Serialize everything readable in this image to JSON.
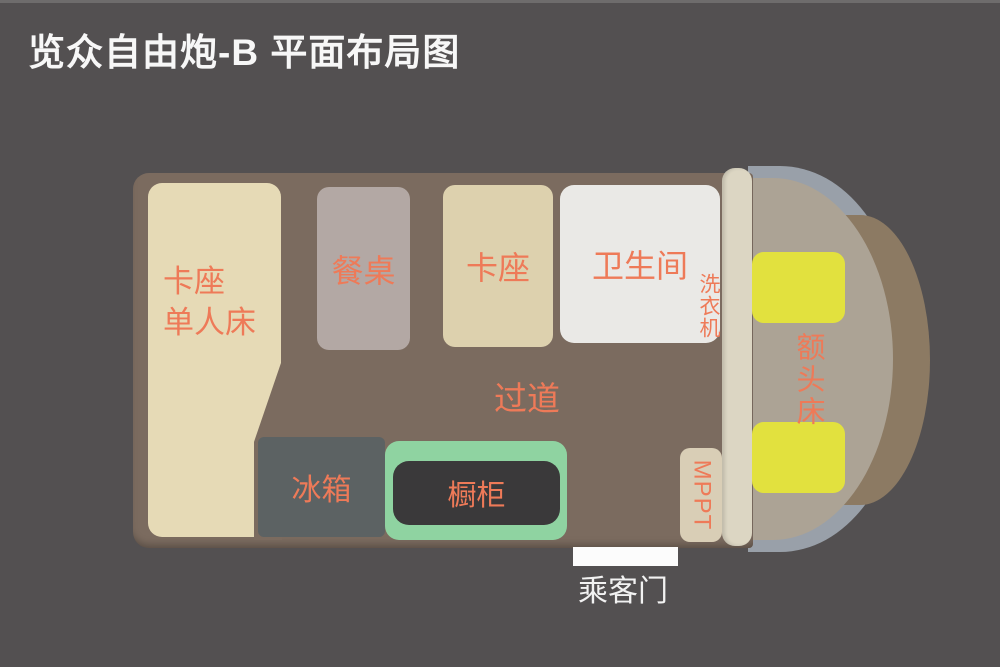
{
  "title": "览众自由炮-B 平面布局图",
  "colors": {
    "background": "#535051",
    "floor": "#7b6b5f",
    "bed": "#e6dab6",
    "dining_table": "#b3a8a4",
    "booth": "#ddd1ae",
    "bathroom": "#eae9e6",
    "fridge": "#5c6263",
    "cabinet_frame": "#8fd3a1",
    "cabinet_inner": "#3a393a",
    "seat": "#e2e13e",
    "partition": "#dcd6c3",
    "cab_floor": "#aca395",
    "windshield_band": "#99a0a9",
    "hood": "#8c7a63",
    "label_orange": "#ee7a58",
    "door_white": "#fcfcfc",
    "title_white": "#f7f7f7"
  },
  "floorplan": {
    "bed": {
      "line1": "卡座",
      "line2": "单人床"
    },
    "dining_table": {
      "label": "餐桌"
    },
    "booth": {
      "label": "卡座"
    },
    "bathroom": {
      "label": "卫生间"
    },
    "washing_machine": {
      "label": "洗衣机"
    },
    "aisle": {
      "label": "过道"
    },
    "fridge": {
      "label": "冰箱"
    },
    "cabinet": {
      "label": "橱柜"
    },
    "mppt": {
      "label": "MPPT"
    },
    "cab_bed": {
      "label": "额头床"
    },
    "passenger_door": {
      "label": "乘客门"
    }
  }
}
